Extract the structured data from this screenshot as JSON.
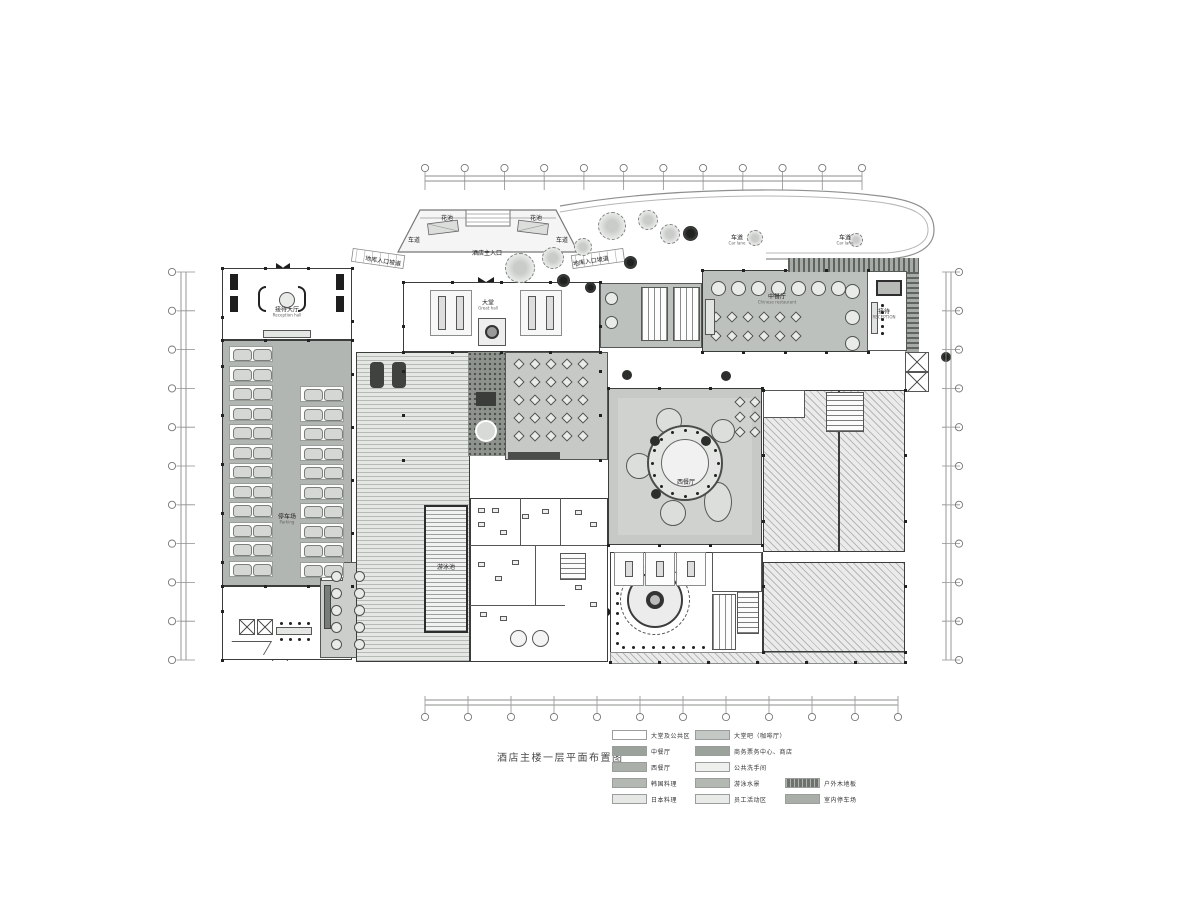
{
  "title": "酒店主楼一层平面布置图",
  "legend": {
    "columns": [
      {
        "x": 612,
        "y": 727,
        "items": [
          {
            "label": "大堂及公共区",
            "swatch": "#ffffff"
          },
          {
            "label": "中餐厅",
            "swatch": "#9ba19b"
          },
          {
            "label": "西餐厅",
            "swatch": "#aaafaa"
          },
          {
            "label": "韩国料理",
            "swatch": "#b3b8b3"
          },
          {
            "label": "日本料理",
            "swatch": "#e6e8e6"
          }
        ]
      },
      {
        "x": 695,
        "y": 727,
        "items": [
          {
            "label": "大堂吧（咖啡厅）",
            "swatch": "#c4c8c4"
          },
          {
            "label": "商务票务中心、商店",
            "swatch": "#9ba19b"
          },
          {
            "label": "公共洗手间",
            "swatch": "#eef0ee"
          },
          {
            "label": "游泳水景",
            "swatch": "#b3b8b3"
          },
          {
            "label": "员工活动区",
            "swatch": "#e9ebe9"
          }
        ]
      },
      {
        "x": 785,
        "y": 775,
        "items": [
          {
            "label": "户外木地板",
            "swatch": "#6d726d",
            "hatched": true
          },
          {
            "label": "室内停车场",
            "swatch": "#a9aea9"
          }
        ]
      }
    ]
  },
  "plan": {
    "labels": [
      {
        "text": "花池",
        "x": 447,
        "y": 219
      },
      {
        "text": "花池",
        "x": 536,
        "y": 219
      },
      {
        "text": "车道",
        "x": 414,
        "y": 241
      },
      {
        "text": "车道",
        "x": 562,
        "y": 241
      },
      {
        "text": "酒店主入口",
        "x": 487,
        "y": 254
      },
      {
        "text": "地库入口坡道",
        "x": 383,
        "y": 262,
        "rot": 9
      },
      {
        "text": "地库入口坡道",
        "x": 591,
        "y": 262,
        "rot": -9
      },
      {
        "text": "接待大厅",
        "sub": "Reception hall",
        "x": 287,
        "y": 313
      },
      {
        "text": "停车场",
        "sub": "Parking",
        "x": 287,
        "y": 520
      },
      {
        "text": "大堂",
        "sub": "Great hall",
        "x": 488,
        "y": 306
      },
      {
        "text": "中餐厅",
        "sub": "Chinese restaurant",
        "x": 777,
        "y": 300
      },
      {
        "text": "车道",
        "sub": "Car lane",
        "x": 737,
        "y": 241
      },
      {
        "text": "车道",
        "sub": "Car lane",
        "x": 845,
        "y": 241
      },
      {
        "text": "接待",
        "sub": "RECEPTION",
        "x": 884,
        "y": 315
      },
      {
        "text": "西餐厅",
        "x": 686,
        "y": 483
      },
      {
        "text": "游泳池",
        "x": 446,
        "y": 568
      }
    ]
  }
}
